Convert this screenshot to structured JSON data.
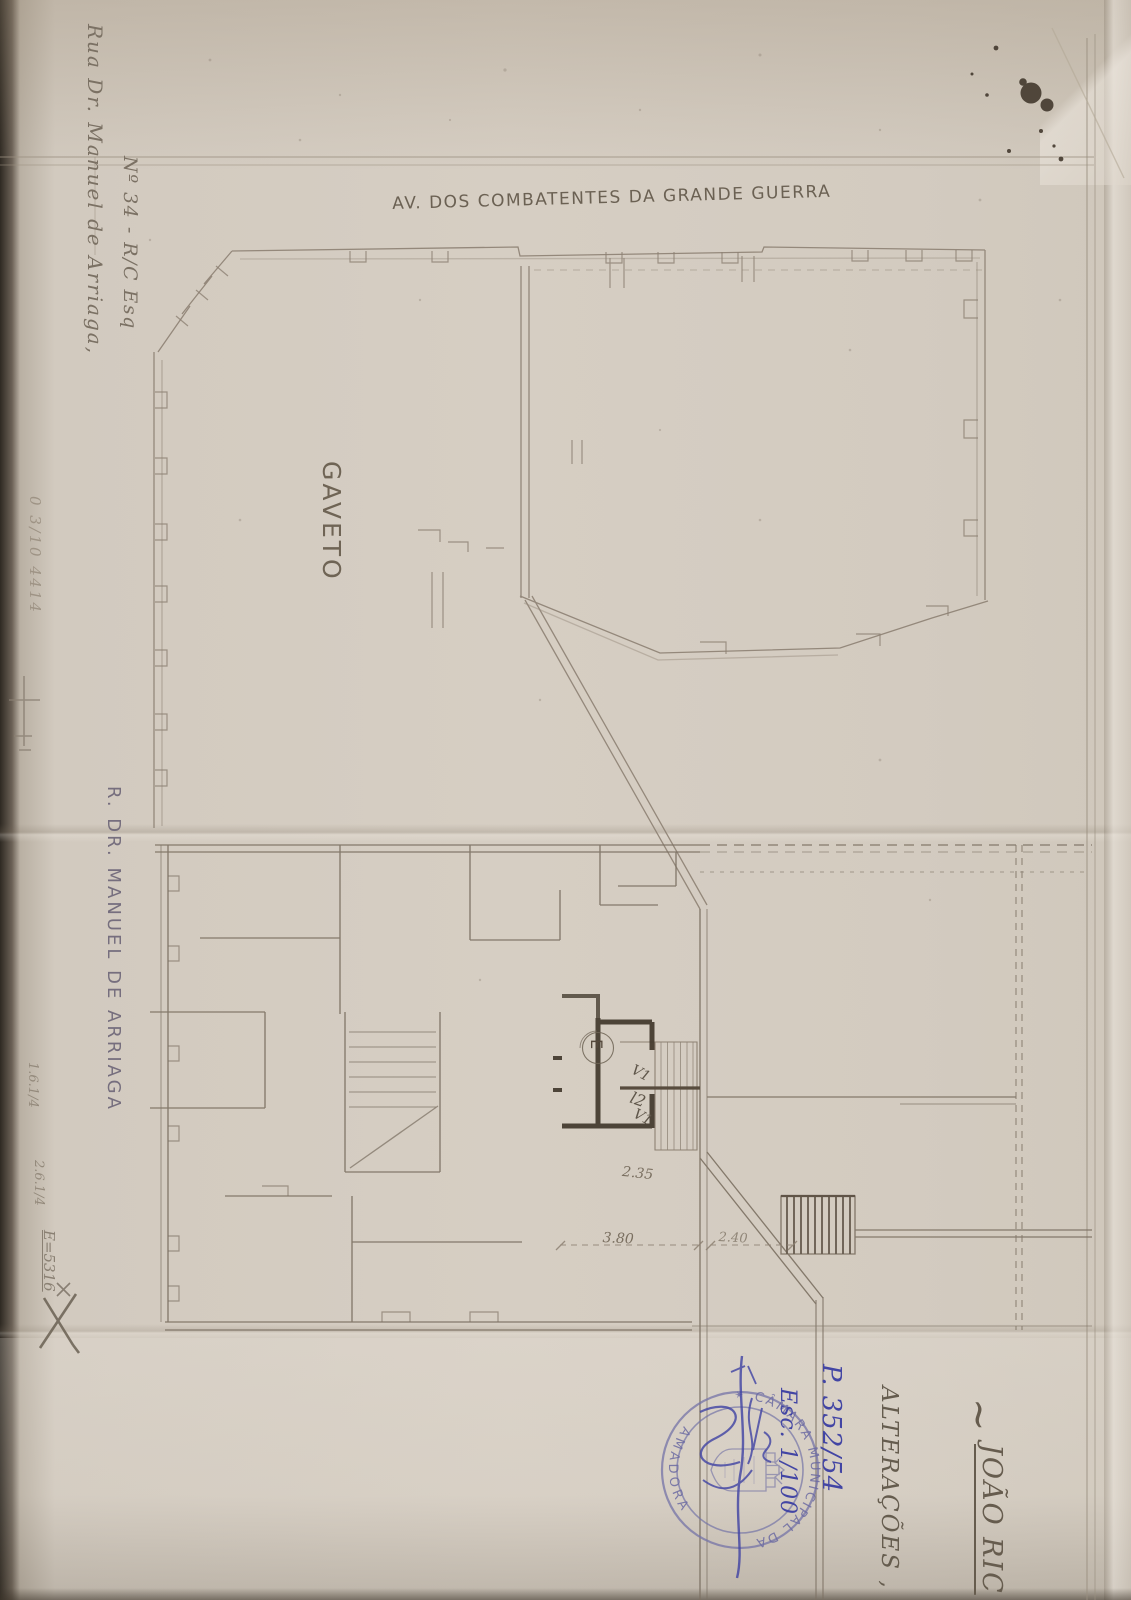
{
  "labels": {
    "avenue": "AV. DOS COMBATENTES DA GRANDE GUERRA",
    "gaveto": "GAVETO",
    "street_left": "R. DR. MANUEL DE ARRIAGA"
  },
  "handwriting": {
    "address_line1": "Rua Dr. Manuel de Arriaga,",
    "address_line2": "Nº 34 - R/C Esq",
    "margin_ref": "0 3/10 4414",
    "tilde": "~",
    "owner_name": "JOÃO RIC",
    "alteracoes": "ALTERAÇÕES ,",
    "process_no": "P. 352/54",
    "scale_note": "Esc. 1/100",
    "note_1": "1.6.1/4",
    "note_2": "2.6.1/4",
    "note_3": "E=5316"
  },
  "stamp": {
    "arc_top": "CÂMARA MUNICIPAL DA",
    "arc_bottom": "AMADORA",
    "star": "✶"
  },
  "plan": {
    "entrance": "E",
    "door_v1_top": "V1",
    "door_l2": "l2",
    "door_v1_bottom": "V1",
    "dim_235": "2.35",
    "dim_380": "3.80",
    "dim_240": "2.40"
  },
  "colors": {
    "paper": "#d4ccc1",
    "pencil": "#857a6b",
    "pencil_dark": "#463d31",
    "ink_blue": "#4245a4",
    "stamp_blue": "#7473a7"
  }
}
